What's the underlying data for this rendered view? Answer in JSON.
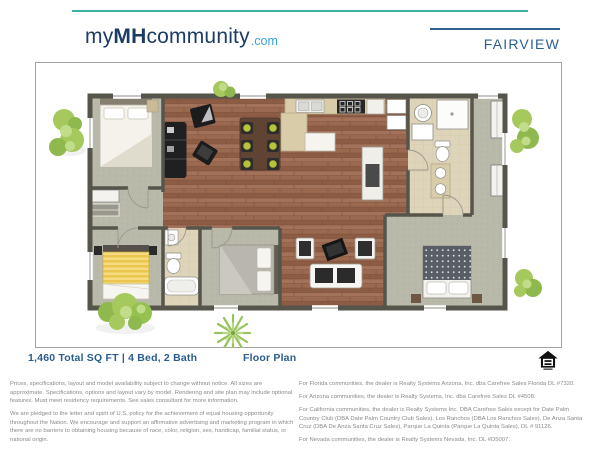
{
  "top_accent": {
    "color": "#3eb2a8"
  },
  "header": {
    "logo_my": "my",
    "logo_mh": "MH",
    "logo_community": "community",
    "logo_tld": ".com",
    "model_name": "FAIRVIEW"
  },
  "caption": {
    "specs": "1,460 Total SQ FT | 4 Bed, 2 Bath",
    "plan_label": "Floor Plan"
  },
  "icons": {
    "equal_housing": "equal-housing-opportunity-icon"
  },
  "floor_plan": {
    "colors": {
      "wall": "#56554b",
      "wood_floor": "#9a6950",
      "carpet": "#b9b9aa",
      "tile": "#ded4ba",
      "counter": "#d9cca8",
      "foliage": "#a6c95e",
      "dining_seat": "#b8c43c"
    }
  },
  "footer": {
    "left_paragraphs": [
      "Prices, specifications, layout and model availability subject to change without notice. All sizes are approximate. Specifications, options and layout vary by model. Rendering and site plan may include optional features. Must meet residency requirements. See sales consultant for more information.",
      "We are pledged to the letter and spirit of U.S. policy for the achievement of equal housing opportunity throughout the Nation. We encourage and support an affirmative advertising and marketing program in which there are no barriers to obtaining housing because of race, color, religion, sex, handicap, familial status, or national origin."
    ],
    "right_paragraphs": [
      "For Florida communities, the dealer is Realty Systems Arizona, Inc. dba Carefree Sales Florida DL #7320.",
      "For Arizona communities, the dealer is Realty Systems, Inc. dba Carefree Sales DL #4508.",
      "For California communities, the dealer is Realty Systems Inc. DBA Carefree Sales except for Date Palm Country Club (DBA Date Palm Country Club Sales), Los Ranchos (DBA Los Ranchos Sales), De Anza Santa Cruz (DBA De Anza Santa Cruz Sales), Parque La Quinta (Parque La Quinta Sales), DL # 91126.",
      "For Nevada communities, the dealer is Realty Systems Nevada, Inc. DL #D5007."
    ]
  }
}
